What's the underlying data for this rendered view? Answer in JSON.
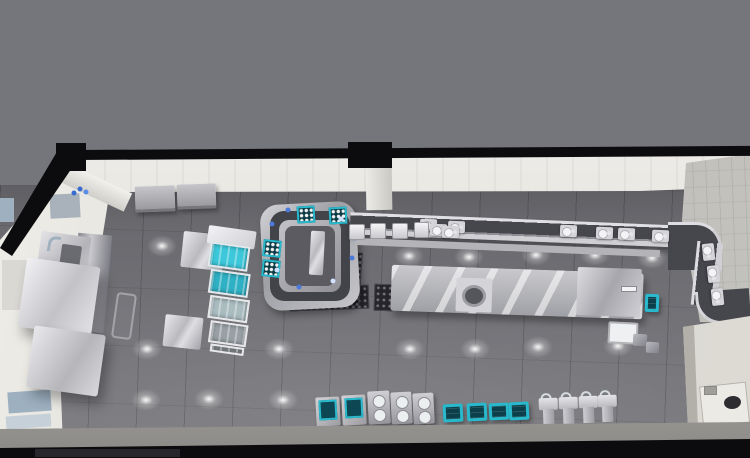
{
  "meta": {
    "view": "3d-top-down-render",
    "subject": "commercial kitchen layout",
    "canvas": {
      "width": 750,
      "height": 458
    }
  },
  "palette": {
    "backdrop": "#75757c",
    "frame-black": "#0c0c0e",
    "soffit-white": "#efeeea",
    "wall-tile-gray": "#8b8b90",
    "right-wall": "#b6b5b1",
    "left-wall": "#e9e7e2",
    "floor": "#6f6f74",
    "belt-dark": "#43434a",
    "steel-bright": "#d9d9dd",
    "steel-mid": "#a8a8ae",
    "teal": "#29b9cd",
    "teal-deep": "#0b4450",
    "panel-blue": "#9fb0c0",
    "room-white": "#dfddd6",
    "glow-white": "#ffffff"
  },
  "scene": {
    "floor_glows": [
      {
        "x": 162,
        "y": 246
      },
      {
        "x": 409,
        "y": 256
      },
      {
        "x": 469,
        "y": 257
      },
      {
        "x": 536,
        "y": 255
      },
      {
        "x": 595,
        "y": 255
      },
      {
        "x": 652,
        "y": 258
      },
      {
        "x": 147,
        "y": 349
      },
      {
        "x": 279,
        "y": 349
      },
      {
        "x": 410,
        "y": 349
      },
      {
        "x": 475,
        "y": 349
      },
      {
        "x": 538,
        "y": 347
      },
      {
        "x": 618,
        "y": 346
      },
      {
        "x": 146,
        "y": 400
      },
      {
        "x": 209,
        "y": 399
      },
      {
        "x": 283,
        "y": 400
      }
    ],
    "wall_panels": [
      {
        "x": 50,
        "y": 194,
        "w": 30,
        "h": 24,
        "c": "#a9b2ba",
        "r": -3
      },
      {
        "x": 0,
        "y": 198,
        "w": 14,
        "h": 24,
        "c": "#9fb0c0",
        "r": 0
      },
      {
        "x": 2,
        "y": 260,
        "w": 30,
        "h": 50,
        "c": "#dad8d3",
        "r": 0
      },
      {
        "x": 8,
        "y": 391,
        "w": 43,
        "h": 21,
        "c": "#9db0c0",
        "r": -4
      },
      {
        "x": 6,
        "y": 415,
        "w": 45,
        "h": 13,
        "c": "#c6d0d8",
        "r": -4
      }
    ],
    "wall_cabinets": [
      {
        "x": 135,
        "y": 186,
        "w": 40,
        "h": 26,
        "r": -2
      },
      {
        "x": 177,
        "y": 184,
        "w": 39,
        "h": 25,
        "r": -2
      }
    ],
    "cup_racks": [
      {
        "x": 297,
        "y": 206,
        "r": -3
      },
      {
        "x": 329,
        "y": 207,
        "r": -3
      },
      {
        "x": 263,
        "y": 240,
        "r": 6
      },
      {
        "x": 262,
        "y": 260,
        "r": 6
      }
    ],
    "belt_plates": [
      {
        "x": 420,
        "y": 219,
        "r": 2
      },
      {
        "x": 448,
        "y": 221,
        "r": 2
      },
      {
        "x": 430,
        "y": 224,
        "r": 2
      },
      {
        "x": 442,
        "y": 226,
        "r": 2
      },
      {
        "x": 560,
        "y": 225,
        "r": 2
      },
      {
        "x": 596,
        "y": 227,
        "r": 2
      },
      {
        "x": 618,
        "y": 228,
        "r": 2
      },
      {
        "x": 652,
        "y": 230,
        "r": 2
      },
      {
        "x": 700,
        "y": 246,
        "r": 84
      },
      {
        "x": 705,
        "y": 268,
        "r": 84
      },
      {
        "x": 709,
        "y": 291,
        "r": 84
      }
    ],
    "belt_items": [
      {
        "x": 272,
        "y": 224,
        "c": "#4a79d8"
      },
      {
        "x": 277,
        "y": 270,
        "c": "#cfe2ff"
      },
      {
        "x": 299,
        "y": 287,
        "c": "#4a79d8"
      },
      {
        "x": 333,
        "y": 281,
        "c": "#cfe2ff"
      },
      {
        "x": 288,
        "y": 210,
        "c": "#4a79d8"
      },
      {
        "x": 341,
        "y": 219,
        "c": "#cfe2ff"
      },
      {
        "x": 355,
        "y": 238,
        "c": "#4a79d8"
      },
      {
        "x": 352,
        "y": 258,
        "c": "#4a79d8"
      },
      {
        "x": 80,
        "y": 189,
        "c": "#3a6bd0"
      },
      {
        "x": 86,
        "y": 192,
        "c": "#5b8de8"
      },
      {
        "x": 74,
        "y": 193,
        "c": "#3a6bd0"
      },
      {
        "x": 62,
        "y": 253,
        "c": "#3a6bd0"
      }
    ],
    "counter_machines": [
      {
        "x": 349,
        "y": 224,
        "w": 16,
        "h": 16
      },
      {
        "x": 370,
        "y": 223,
        "w": 16,
        "h": 16
      },
      {
        "x": 392,
        "y": 223,
        "w": 16,
        "h": 16
      },
      {
        "x": 414,
        "y": 222,
        "w": 15,
        "h": 16
      }
    ],
    "rack_cells": [
      {
        "x": 4,
        "y": 16,
        "w": 40,
        "h": 25,
        "c": "#3cc8da"
      },
      {
        "x": 8,
        "y": 43,
        "w": 40,
        "h": 24,
        "c": "#2fb0c4"
      },
      {
        "x": 11,
        "y": 69,
        "w": 40,
        "h": 23,
        "c": "#a9bcc0"
      },
      {
        "x": 15,
        "y": 94,
        "w": 38,
        "h": 22,
        "c": "#98a0a5"
      },
      {
        "x": 18,
        "y": 117,
        "w": 34,
        "h": 8,
        "c": "#8a9094"
      }
    ],
    "teal_top_units": [
      {
        "x": 316,
        "y": 397,
        "w": 24,
        "h": 29,
        "r": -3
      },
      {
        "x": 342,
        "y": 395,
        "w": 24,
        "h": 30,
        "r": -3
      }
    ],
    "burner_units": [
      {
        "x": 368,
        "y": 391,
        "w": 22,
        "h": 33,
        "r": -3
      },
      {
        "x": 391,
        "y": 392,
        "w": 21,
        "h": 32,
        "r": -3
      },
      {
        "x": 413,
        "y": 393,
        "w": 21,
        "h": 31,
        "r": -3
      }
    ],
    "teal_bins": [
      {
        "x": 443,
        "y": 404,
        "w": 20,
        "h": 18,
        "r": -3
      },
      {
        "x": 467,
        "y": 403,
        "w": 20,
        "h": 18,
        "r": -3
      },
      {
        "x": 489,
        "y": 403,
        "w": 20,
        "h": 17,
        "r": -3
      },
      {
        "x": 509,
        "y": 402,
        "w": 20,
        "h": 18,
        "r": -3
      },
      {
        "x": 645,
        "y": 294,
        "w": 14,
        "h": 18,
        "r": 2
      }
    ],
    "wash_sinks": [
      {
        "x": 539,
        "y": 396,
        "r": -2
      },
      {
        "x": 559,
        "y": 395,
        "r": -2
      },
      {
        "x": 579,
        "y": 394,
        "r": -2
      },
      {
        "x": 598,
        "y": 393,
        "r": -2
      }
    ],
    "seats": [
      {
        "x": 633,
        "y": 334,
        "w": 14,
        "h": 12,
        "r": 3
      },
      {
        "x": 646,
        "y": 342,
        "w": 13,
        "h": 11,
        "r": 3
      }
    ]
  }
}
